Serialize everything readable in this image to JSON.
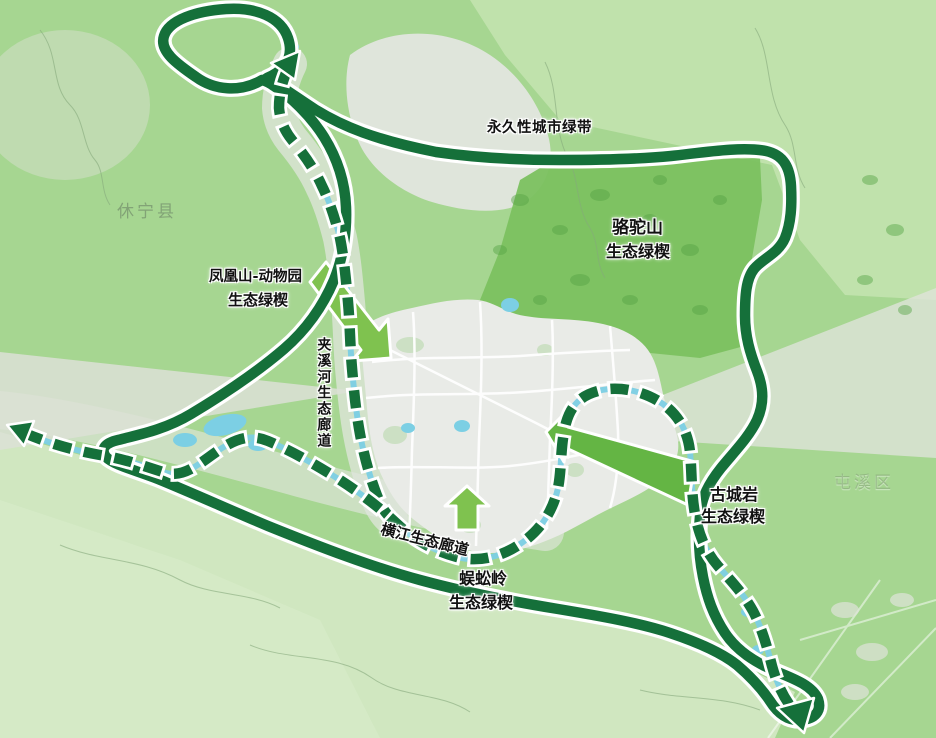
{
  "map_labels": {
    "permanent_green_belt": "永久性城市绿带",
    "luotuoshan": {
      "line1": "骆驼山",
      "line2": "生态绿楔"
    },
    "fenghuangshan": {
      "line1": "凤凰山-动物园",
      "line2": "生态绿楔"
    },
    "jiaxihe_corridor": "夹溪河生态廊道",
    "hengjiang_corridor": "横江生态廊道",
    "wugongling": {
      "line1": "蜈蚣岭",
      "line2": "生态绿楔"
    },
    "guchengyan": {
      "line1": "古城岩",
      "line2": "生态绿楔"
    },
    "xiuning_county": "休宁县",
    "tunxi_district": "屯溪区"
  },
  "colors": {
    "belt_green": "#15703a",
    "wedge_arrow_green": "#7fc24f",
    "wedge_arrow_deep": "#64b544",
    "hill_green": "#7bc160",
    "base_green": "#a6d691",
    "light_green_ne": "#c0e2ac",
    "pale_green_sw": "#d0e7c0",
    "valley_gray": "#e0e5dd",
    "city_gray": "#e9ebe7",
    "water_blue": "#7ccfe4"
  }
}
